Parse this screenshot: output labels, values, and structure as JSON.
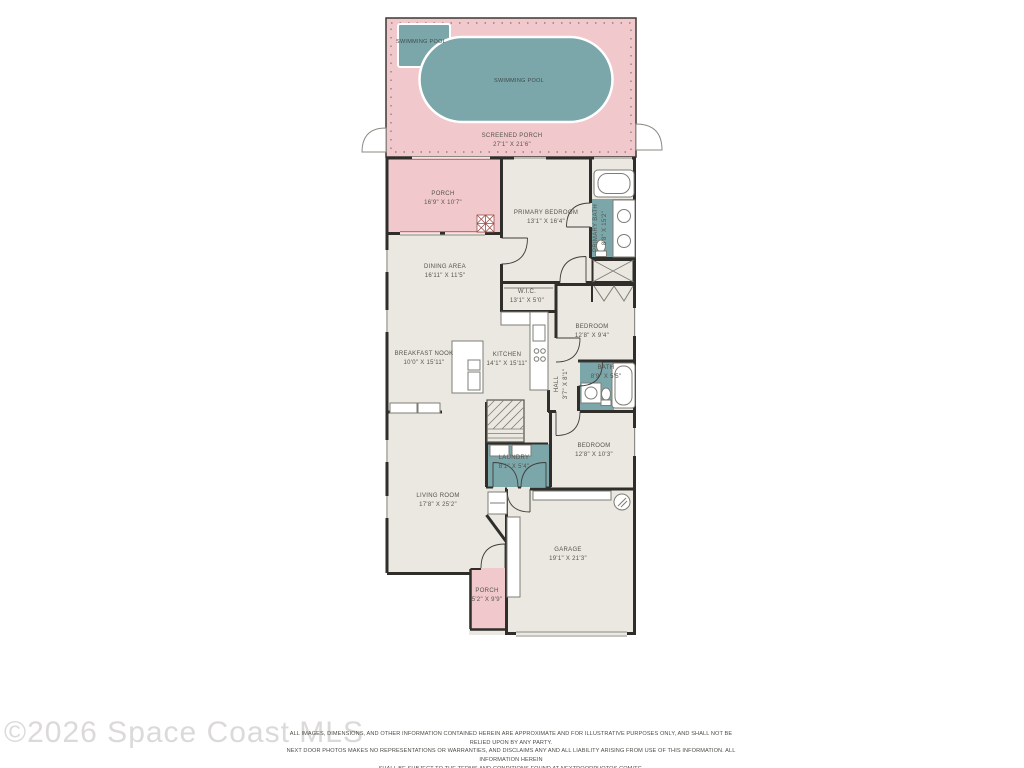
{
  "watermark": "©2026 Space Coast MLS",
  "disclaimer": {
    "lines": [
      "ALL IMAGES, DIMENSIONS, AND OTHER INFORMATION CONTAINED HEREIN ARE APPROXIMATE AND FOR ILLUSTRATIVE PURPOSES ONLY, AND SHALL NOT BE RELIED UPON BY ANY PARTY.",
      "NEXT DOOR PHOTOS MAKES NO REPRESENTATIONS OR WARRANTIES, AND DISCLAIMS ANY AND ALL LIABILITY ARISING FROM USE OF THIS INFORMATION. ALL INFORMATION HEREIN",
      "SHALL BE SUBJECT TO THE TERMS AND CONDITIONS FOUND AT NEXTDOORPHOTOS.COM/TC."
    ]
  },
  "colors": {
    "porch_pink": "#f1c9cd",
    "pool_teal": "#7ba6aa",
    "floor_beige": "#eae8e0",
    "wall_dark": "#2f2e2a",
    "wet_room_teal": "#7ba6aa",
    "watermark_gray": "#dbdad8"
  },
  "rooms": {
    "swimming_pool_small": {
      "name": "SWIMMING POOL"
    },
    "swimming_pool": {
      "name": "SWIMMING POOL"
    },
    "screened_porch": {
      "name": "SCREENED PORCH",
      "dims": "27'1\" X 21'6\""
    },
    "porch_upper": {
      "name": "PORCH",
      "dims": "16'9\" X 10'7\""
    },
    "primary_bedroom": {
      "name": "PRIMARY BEDROOM",
      "dims": "13'1\" X 16'4\""
    },
    "primary_bath": {
      "name": "PRIMARY BATH",
      "dims": "8'8\" X 15'2\""
    },
    "dining_area": {
      "name": "DINING AREA",
      "dims": "16'11\" X 11'5\""
    },
    "wic": {
      "name": "W.I.C.",
      "dims": "13'1\" X 5'0\""
    },
    "bedroom_mid": {
      "name": "BEDROOM",
      "dims": "12'8\" X 9'4\""
    },
    "breakfast_nook": {
      "name": "BREAKFAST NOOK",
      "dims": "10'0\" X 15'11\""
    },
    "kitchen": {
      "name": "KITCHEN",
      "dims": "14'1\" X 15'11\""
    },
    "hall": {
      "name": "HALL",
      "dims": "3'7\" X 8'1\""
    },
    "bath": {
      "name": "BATH",
      "dims": "8'9\" X 5'5\""
    },
    "laundry": {
      "name": "LAUNDRY",
      "dims": "8'1\" X 5'4\""
    },
    "bedroom_lower": {
      "name": "BEDROOM",
      "dims": "12'8\" X 10'3\""
    },
    "living_room": {
      "name": "LIVING ROOM",
      "dims": "17'8\" X 25'2\""
    },
    "garage": {
      "name": "GARAGE",
      "dims": "19'1\" X 21'3\""
    },
    "porch_lower": {
      "name": "PORCH",
      "dims": "5'2\" X 9'9\""
    }
  }
}
